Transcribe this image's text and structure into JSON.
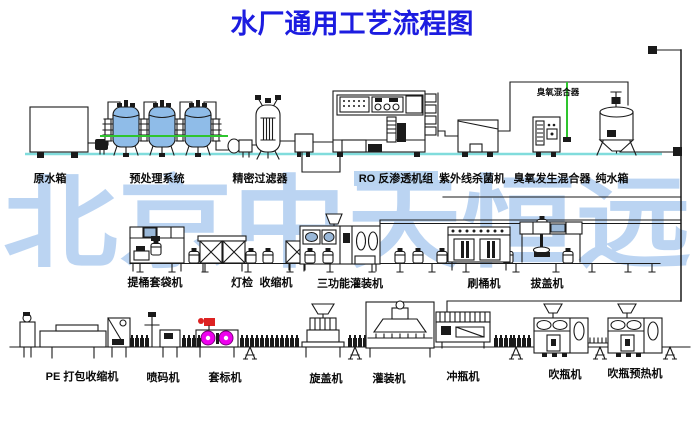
{
  "title": "水厂通用工艺流程图",
  "watermark": "北京中天恒远",
  "colors": {
    "title": "#1c1ce0",
    "watermark": "#a9c9ef",
    "line": "#1a1a1a",
    "tank-fill": "#8fbce8",
    "green-pipe": "#2ec52e",
    "cyan-baseline": "#80dcdc",
    "magenta-roll": "#ee00ee",
    "red-flag": "#dd2222",
    "label-highlight": "#b9d4f1",
    "panel-blue": "#9ab8d8"
  },
  "row1_labels": {
    "raw_water_tank": "原水箱",
    "pretreatment": "预处理系统",
    "precision_filter": "精密过滤器",
    "ro_unit": "RO 反渗透机组",
    "uv_sterilizer": "紫外线杀菌机",
    "ozone_generator": "臭氧发生混合器",
    "pure_water_tank": "纯水箱",
    "ozone_mixer_pipe": "臭氧混合器"
  },
  "row2_labels": {
    "bucket_bagging": "提桶套袋机",
    "light_inspection": "灯检",
    "shrink_machine": "收缩机",
    "three_function_filler": "三功能灌装机",
    "bucket_brusher": "刷桶机",
    "cap_remover": "拔盖机"
  },
  "row3_labels": {
    "pe_pack_shrink": "PE 打包收缩机",
    "inkjet_coder": "喷码机",
    "labeler": "套标机",
    "capper": "旋盖机",
    "filler": "灌装机",
    "bottle_rinser": "冲瓶机",
    "bottle_blower": "吹瓶机",
    "bottle_preheater": "吹瓶预热机"
  }
}
